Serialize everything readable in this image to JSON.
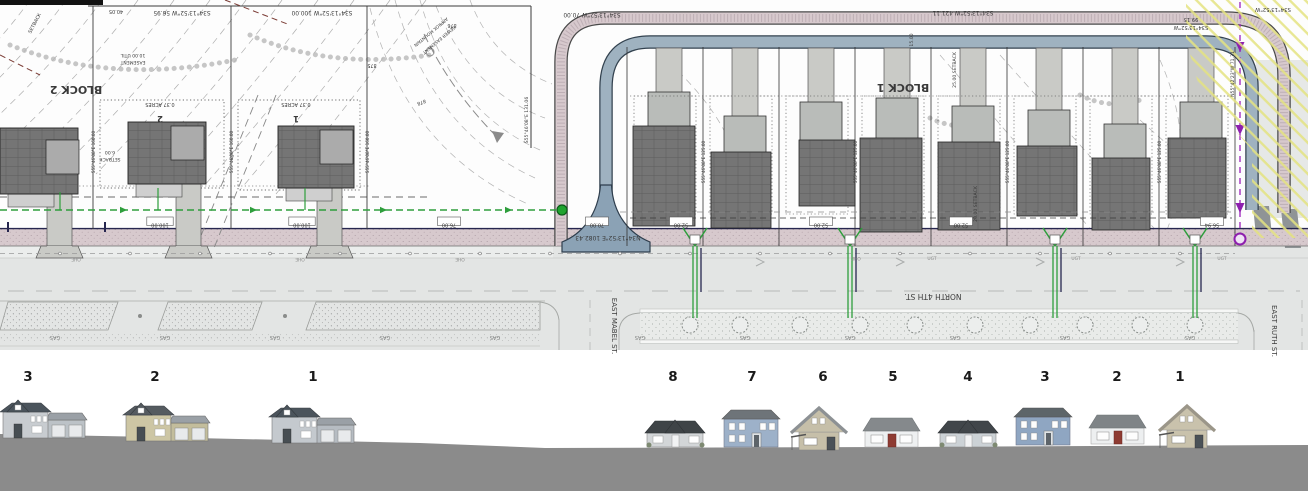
{
  "sheet": {
    "description": "Subdivision site plan with street elevations",
    "colors": {
      "trail_band": "#d7c9cd",
      "drainage_band": "#9fb2c0",
      "drainage_edge": "#33424f",
      "utility_green": "#2e9e3c",
      "sewer_purple": "#a22ec0",
      "hatch_yellow": "#e4e380",
      "street_gray": "#e3e5e4",
      "footprint_gray": "#757575",
      "driveway_gray": "#c9cac6",
      "ground_gray": "#8b8b8b"
    }
  },
  "plan": {
    "labels": [
      {
        "text": "S34°13'52\"W  56.95",
        "x": 182,
        "y": 11,
        "r": 180,
        "s": 5.8
      },
      {
        "text": "S34°13'52\"W  100.00",
        "x": 322,
        "y": 11,
        "r": 180,
        "s": 5.8
      },
      {
        "text": "S34°13'52\"W  70.00",
        "x": 592,
        "y": 13,
        "r": 180,
        "s": 5.8
      },
      {
        "text": "S34°13'52\"W  421.11",
        "x": 963,
        "y": 11,
        "r": 180,
        "s": 5.8
      },
      {
        "text": "99.15",
        "x": 1191,
        "y": 18,
        "r": 180,
        "s": 5.2
      },
      {
        "text": "S34°13'52\"W",
        "x": 1191,
        "y": 26,
        "r": 180,
        "s": 5.2
      },
      {
        "text": "S34°13'52\"W",
        "x": 1273,
        "y": 8,
        "r": 180,
        "s": 5.4
      },
      {
        "text": "40.05",
        "x": 116,
        "y": 10,
        "r": 180,
        "s": 5
      },
      {
        "text": "SETBACK",
        "x": 36,
        "y": 24,
        "r": -62,
        "s": 4.8
      },
      {
        "text": "BLOCK 2",
        "x": 76,
        "y": 86,
        "r": 180,
        "s": 11,
        "b": true
      },
      {
        "text": "BLOCK 1",
        "x": 903,
        "y": 84,
        "r": 180,
        "s": 11,
        "b": true
      },
      {
        "text": "0.37 ACRES",
        "x": 160,
        "y": 103,
        "r": 180,
        "s": 5
      },
      {
        "text": "2",
        "x": 160,
        "y": 116,
        "r": 180,
        "s": 8.5,
        "b": true
      },
      {
        "text": "0.37 ACRES",
        "x": 296,
        "y": 103,
        "r": 180,
        "s": 5
      },
      {
        "text": "1",
        "x": 296,
        "y": 116,
        "r": 180,
        "s": 8.5,
        "b": true
      },
      {
        "text": "10.00 UTIL",
        "x": 133,
        "y": 54,
        "r": 180,
        "s": 4.6
      },
      {
        "text": "EASEMENT",
        "x": 133,
        "y": 61,
        "r": 180,
        "s": 4.6
      },
      {
        "text": "APPROX MOUNTAIN",
        "x": 430,
        "y": 31,
        "r": 140,
        "s": 4.4
      },
      {
        "text": "SEWER EASEMENT",
        "x": 438,
        "y": 39,
        "r": 140,
        "s": 4.4
      },
      {
        "text": "875",
        "x": 372,
        "y": 64,
        "r": 180,
        "s": 4.8
      },
      {
        "text": "876",
        "x": 452,
        "y": 24,
        "r": 180,
        "s": 4.8
      },
      {
        "text": "878",
        "x": 421,
        "y": 101,
        "r": 160,
        "s": 4.8
      },
      {
        "text": "6.00",
        "x": 110,
        "y": 151,
        "r": 180,
        "s": 4.6
      },
      {
        "text": "SETBACK",
        "x": 110,
        "y": 158,
        "r": 180,
        "s": 4.6
      },
      {
        "text": "N34°13'52\"E  1082.43",
        "x": 608,
        "y": 236,
        "r": 180,
        "s": 6
      },
      {
        "text": "15.00",
        "x": 913,
        "y": 40,
        "r": -90,
        "s": 4.6
      },
      {
        "text": "25.00 SETBACK",
        "x": 956,
        "y": 70,
        "r": -90,
        "s": 4.6
      },
      {
        "text": "20.00 SETBACK",
        "x": 977,
        "y": 204,
        "r": -90,
        "s": 4.6
      },
      {
        "text": "NORTH 4TH ST.",
        "x": 933,
        "y": 294,
        "r": 180,
        "s": 7.5
      },
      {
        "text": "EAST MABEL ST.",
        "x": 612,
        "y": 326,
        "r": 90,
        "s": 7
      },
      {
        "text": "EAST RUTH ST.",
        "x": 1272,
        "y": 331,
        "r": 90,
        "s": 7
      },
      {
        "text": "N55°42'23\"W  71.31",
        "x": 1234,
        "y": 74,
        "r": -90,
        "s": 4.6
      },
      {
        "text": "S55°46'08\"E  131.06",
        "x": 528,
        "y": 120,
        "r": -90,
        "s": 4.6
      },
      {
        "text": "S55°46'08\"E  160.00",
        "x": 95,
        "y": 152,
        "r": -90,
        "s": 4.2
      },
      {
        "text": "S55°46'08\"E  160.00",
        "x": 233,
        "y": 152,
        "r": -90,
        "s": 4.2
      },
      {
        "text": "S55°46'08\"E  160.00",
        "x": 369,
        "y": 152,
        "r": -90,
        "s": 4.2
      },
      {
        "text": "S55°46'08\"E  125.00",
        "x": 705,
        "y": 162,
        "r": -90,
        "s": 4.2
      },
      {
        "text": "S55°46'08\"E  125.00",
        "x": 857,
        "y": 162,
        "r": -90,
        "s": 4.2
      },
      {
        "text": "S55°46'08\"E  125.00",
        "x": 1009,
        "y": 162,
        "r": -90,
        "s": 4.2
      },
      {
        "text": "S55°46'08\"E  125.00",
        "x": 1161,
        "y": 162,
        "r": -90,
        "s": 4.2
      },
      {
        "text": "OHE",
        "x": 76,
        "y": 258,
        "r": 180,
        "s": 4.4,
        "c": "#8a8a8a"
      },
      {
        "text": "OHE",
        "x": 300,
        "y": 258,
        "r": 180,
        "s": 4.4,
        "c": "#8a8a8a"
      },
      {
        "text": "OHE",
        "x": 460,
        "y": 258,
        "r": 180,
        "s": 4.4,
        "c": "#8a8a8a"
      },
      {
        "text": "OHE",
        "x": 856,
        "y": 257,
        "r": 180,
        "s": 4.4,
        "c": "#8a8a8a"
      },
      {
        "text": "UGT",
        "x": 932,
        "y": 260,
        "r": 0,
        "s": 4.4,
        "c": "#8a8a8a"
      },
      {
        "text": "UGT",
        "x": 1076,
        "y": 260,
        "r": 0,
        "s": 4.4,
        "c": "#8a8a8a"
      },
      {
        "text": "UGT",
        "x": 1222,
        "y": 260,
        "r": 0,
        "s": 4.4,
        "c": "#8a8a8a"
      }
    ],
    "dims": [
      {
        "text": "76.00",
        "x": 449
      },
      {
        "text": "100.00",
        "x": 160
      },
      {
        "text": "100.00",
        "x": 302
      },
      {
        "text": "70.00",
        "x": 597
      },
      {
        "text": "52.00",
        "x": 681
      },
      {
        "text": "52.00",
        "x": 821
      },
      {
        "text": "52.00",
        "x": 961
      },
      {
        "text": "56.94",
        "x": 1212
      }
    ],
    "gas": {
      "label": "GAS",
      "y": 336,
      "xs": [
        55,
        165,
        275,
        385,
        495,
        640,
        745,
        850,
        955,
        1065,
        1190
      ]
    }
  },
  "elevation": {
    "ground_color": "#8b8b8b",
    "number_y": 21,
    "houses": [
      {
        "label": "3",
        "num_x": 28,
        "x": 3,
        "base": 78,
        "type": "twostory_garage",
        "siding": "#c8ccd0",
        "roof": "#4b545c",
        "accent": "#bcc2c7"
      },
      {
        "label": "2",
        "num_x": 155,
        "x": 126,
        "base": 81,
        "type": "twostory_garage",
        "siding": "#cdc6a4",
        "roof": "#555b60",
        "accent": "#c3bd9c"
      },
      {
        "label": "1",
        "num_x": 313,
        "x": 272,
        "base": 83,
        "type": "twostory_garage",
        "siding": "#c4c9ce",
        "roof": "#4b545c",
        "accent": "#b6bcc2"
      },
      {
        "label": "8",
        "num_x": 673,
        "x": 645,
        "base": 87,
        "type": "ranch",
        "siding": "#d3d6d8",
        "roof": "#3f4447"
      },
      {
        "label": "7",
        "num_x": 752,
        "x": 722,
        "base": 87,
        "type": "twostory",
        "siding": "#9db1c9",
        "roof": "#6e7479"
      },
      {
        "label": "6",
        "num_x": 823,
        "x": 789,
        "base": 90,
        "type": "cottage",
        "siding": "#c6bfa9",
        "roof": "#8d9194"
      },
      {
        "label": "5",
        "num_x": 893,
        "x": 863,
        "base": 87,
        "type": "bungalow",
        "siding": "#eef0f1",
        "roof": "#85898c",
        "door": "#8e3b32"
      },
      {
        "label": "4",
        "num_x": 968,
        "x": 938,
        "base": 87,
        "type": "ranch",
        "siding": "#ccd2d6",
        "roof": "#41464a"
      },
      {
        "label": "3",
        "num_x": 1045,
        "x": 1014,
        "base": 85,
        "type": "twostory",
        "siding": "#8fa6c2",
        "roof": "#5d6569"
      },
      {
        "label": "2",
        "num_x": 1117,
        "x": 1089,
        "base": 84,
        "type": "bungalow",
        "siding": "#edeff0",
        "roof": "#7f8487",
        "door": "#8e3b32"
      },
      {
        "label": "1",
        "num_x": 1180,
        "x": 1157,
        "base": 88,
        "type": "cottage",
        "siding": "#c9c2ac",
        "roof": "#9b9689"
      }
    ]
  }
}
